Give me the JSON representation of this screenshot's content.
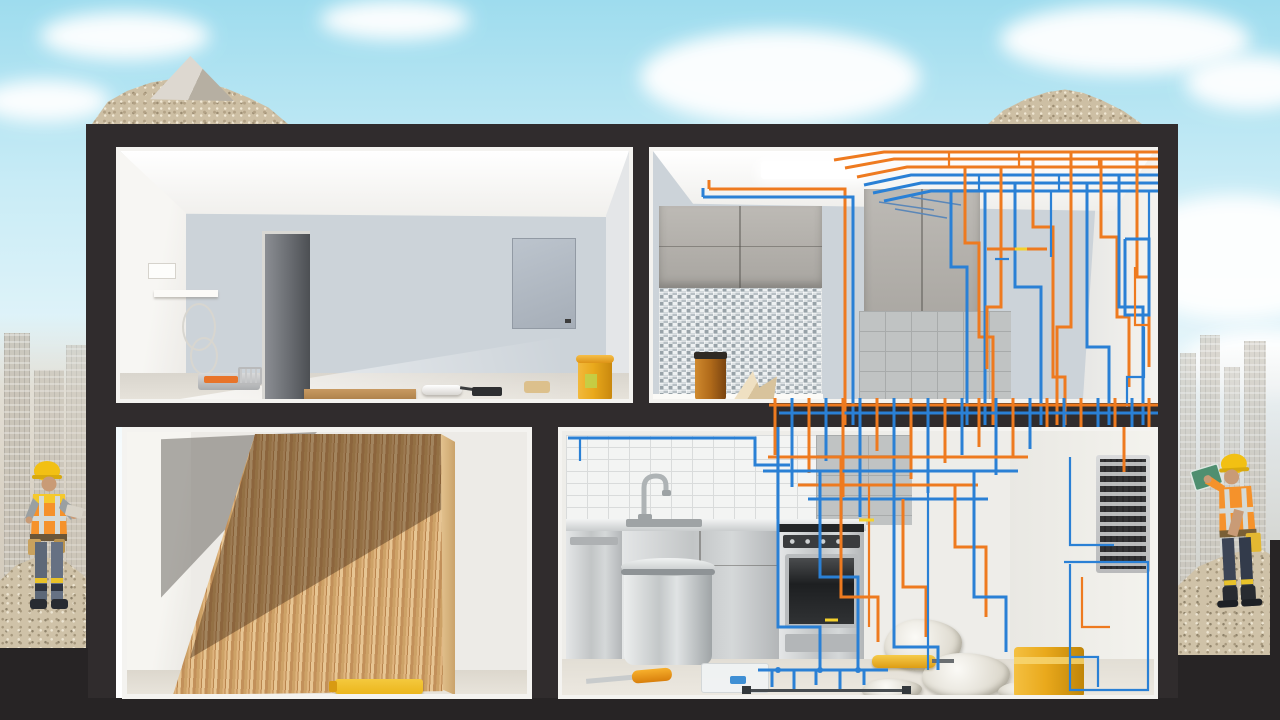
{
  "meta": {
    "description": "3D cutaway render of a two-storey apartment under renovation, flanked by construction workers on rubble piles with faded city skylines behind",
    "width_px": 1280,
    "height_px": 720
  },
  "palette": {
    "sky_top": "#9edcee",
    "sky_mid": "#c9ecf6",
    "cloud_white": "#ffffff",
    "frame_dark": "#302c2d",
    "frame_deep": "#272425",
    "wall_white": "#f4f3f0",
    "wall_bluegray": "#ccd3d9",
    "counter_white": "#f8f7f4",
    "concrete": "#ddd8d0",
    "tile_white_bg": "#f3f4f3",
    "tile_line": "#d9dbdb",
    "tile_gray_bg": "#c0c3c3",
    "tile_gray_line": "#a8abab",
    "wood_edge": "#e3c28e",
    "pipe_orange": "#ee7a1f",
    "pipe_blue": "#2a80d5",
    "pipe_yellow": "#f5d12c",
    "bucket_yellow": "#e9a91c",
    "bucket_orange": "#e8742a",
    "amber_jar": "#b06a1a",
    "sponge_tan": "#dcc08c",
    "level_yellow": "#ecb61c",
    "dirt_tan": "#cdbfa4",
    "gravel": "#cfc2a8",
    "city_fade": "#c6c0b4",
    "helmet_yellow": "#f2c013",
    "vest_orange": "#f5922b",
    "vest_yellow": "#f5c92c",
    "stripe_silver": "#d5dad6",
    "skin": "#c99b76",
    "pants_gray": "#5d6878",
    "jeans_blue": "#3c4556",
    "boot_dark": "#282b31",
    "green_board": "#4f8f70"
  },
  "scene": {
    "regions": {
      "sky": {
        "label": "sky",
        "description": "Light blue sky with soft white clouds"
      },
      "left_city": {
        "label": "left-city-strip",
        "description": "Faded city skyline photo strip, left edge"
      },
      "right_city": {
        "label": "right-city-strip",
        "description": "Faded skyscraper skyline photo strip, right edge"
      },
      "house_frame": {
        "label": "house-frame",
        "description": "Dark cutaway shell of the building"
      },
      "top_left_room": {
        "label": "empty-room",
        "description": "Empty room being plastered: door, wall panel, shelf, paint tray, plank, roller, brush, sponge, yellow bucket"
      },
      "top_right_room": {
        "label": "upper-kitchen",
        "description": "Kitchen corner with gray cabinets, mosaic backsplash, ceiling light and dense orange/blue piping"
      },
      "bottom_left_room": {
        "label": "flooring-room",
        "description": "Room with large diagonal hardwood floor panel over concrete subfloor, spacers and yellow level"
      },
      "bottom_right_room": {
        "label": "lower-kitchen",
        "description": "Stainless kitchen: dishwasher, sink, oven, metal bucket, tools, drop cloths, electrical panel, pipe maze"
      }
    },
    "workers": [
      {
        "position": "left",
        "gear": [
          "yellow-hard-hat",
          "hi-vis-vest",
          "tool-belt",
          "gray-work-pants",
          "boots"
        ],
        "action": "standing on gravel pile holding notes"
      },
      {
        "position": "right",
        "gear": [
          "yellow-hard-hat",
          "orange-vest",
          "yellow-tool-pouch",
          "navy-jeans",
          "boots"
        ],
        "action": "standing on rubble holding up a green board"
      }
    ],
    "objects": {
      "roof": [
        "dirt-mound-left",
        "concrete-chunk",
        "dirt-mound-right"
      ],
      "piping_colors": [
        "orange",
        "blue",
        "yellow-accents"
      ]
    }
  }
}
